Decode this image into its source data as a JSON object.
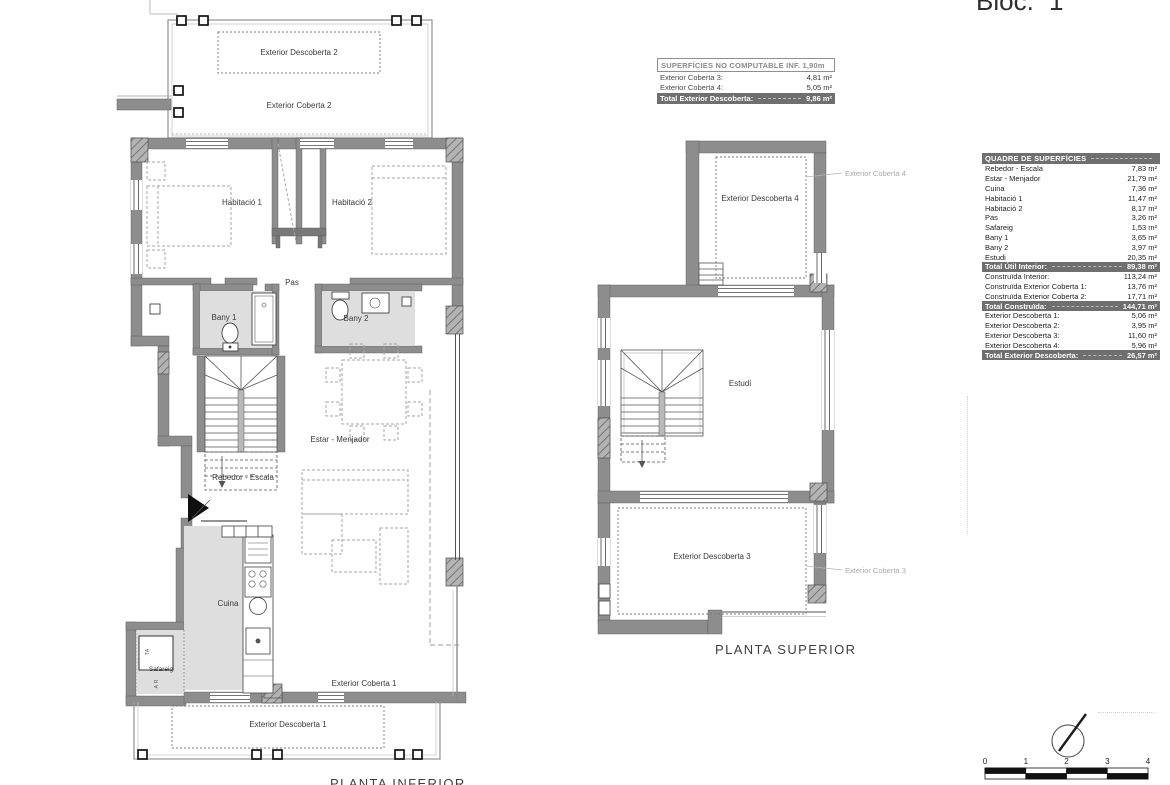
{
  "title_block": {
    "bloc_label": "Bloc.",
    "bloc_number": "1"
  },
  "no_computable_table": {
    "header": "SUPERFÍCIES NO COMPUTABLE INF. 1,90m",
    "rows": [
      {
        "label": "Exterior Coberta 3:",
        "value": "4,81 m²"
      },
      {
        "label": "Exterior Coberta 4:",
        "value": "5,05 m²"
      }
    ],
    "total": {
      "label": "Total Exterior Descoberta:",
      "value": "9,86 m²"
    }
  },
  "quadre_table": {
    "header": "QUADRE DE SUPERFÍCIES",
    "rows": [
      {
        "label": "Rebedor - Escala",
        "value": "7,83 m²"
      },
      {
        "label": "Estar - Menjador",
        "value": "21,79 m²"
      },
      {
        "label": "Cuina",
        "value": "7,36 m²"
      },
      {
        "label": "Habitació 1",
        "value": "11,47 m²"
      },
      {
        "label": "Habitació 2",
        "value": "8,17 m²"
      },
      {
        "label": "Pas",
        "value": "3,26 m²"
      },
      {
        "label": "Safareig",
        "value": "1,53 m²"
      },
      {
        "label": "Bany 1",
        "value": "3,65 m²"
      },
      {
        "label": "Bany 2",
        "value": "3,97 m²"
      },
      {
        "label": "Estudi",
        "value": "20,35 m²"
      },
      {
        "label": "Total Útil Interior:",
        "value": "89,38 m²"
      },
      {
        "label": "Construïda Interior:",
        "value": "113,24 m²"
      },
      {
        "label": "Construïda Exterior Coberta 1:",
        "value": "13,76 m²"
      },
      {
        "label": "Construïda Exterior Coberta 2:",
        "value": "17,71 m²"
      },
      {
        "label": "Total Construïda:",
        "value": "144,71 m²"
      },
      {
        "label": "Exterior Descoberta 1:",
        "value": "5,06 m²"
      },
      {
        "label": "Exterior Descoberta 2:",
        "value": "3,95 m²"
      },
      {
        "label": "Exterior Descoberta 3:",
        "value": "11,60 m²"
      },
      {
        "label": "Exterior Descoberta 4:",
        "value": "5,96 m²"
      },
      {
        "label": "Total Exterior Descoberta:",
        "value": "26,57 m²"
      }
    ]
  },
  "planta_inferior": {
    "title": "PLANTA INFERIOR",
    "labels": {
      "exterior_descoberta_2": "Exterior Descoberta 2",
      "exterior_coberta_2": "Exterior Coberta 2",
      "habitacio_1": "Habitació 1",
      "habitacio_2": "Habitació 2",
      "pas": "Pas",
      "bany_1": "Bany 1",
      "bany_2": "Bany 2",
      "estar_menjador": "Estar - Menjador",
      "rebedor_escala": "Rebedor - Escala",
      "cuina": "Cuina",
      "safareig": "Safareig",
      "ta": "TA",
      "ar": "A R",
      "exterior_coberta_1": "Exterior Coberta 1",
      "exterior_descoberta_1": "Exterior Descoberta 1"
    }
  },
  "planta_superior": {
    "title": "PLANTA SUPERIOR",
    "labels": {
      "exterior_descoberta_4": "Exterior Descoberta 4",
      "exterior_coberta_4": "Exterior Coberta 4",
      "estudi": "Estudi",
      "exterior_descoberta_3": "Exterior Descoberta 3",
      "exterior_coberta_3": "Exterior Coberta 3"
    }
  },
  "scale_bar": {
    "ticks": [
      "0",
      "1",
      "2",
      "3",
      "4"
    ]
  },
  "colors": {
    "wall": "#8d8d8d",
    "room_fill": "#dedede",
    "table_dark": "#6f6f6f",
    "muted_label": "#a8a8a8"
  }
}
